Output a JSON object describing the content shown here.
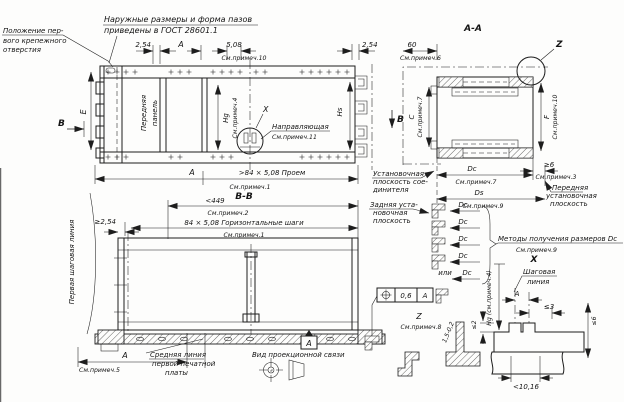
{
  "colors": {
    "ink": "#1d1d1d",
    "paper": "#fdfdfc"
  },
  "icons": {
    "position_tolerance": "circle-crosshair",
    "projection_symbol": "first-angle-truncated-cone"
  },
  "notes": {
    "outer_1": "Наружные размеры и форма пазов",
    "outer_2": "приведены в ГОСТ 28601.1",
    "hole_1": "Положение пер-",
    "hole_2": "вого крепежного",
    "hole_3": "отверстия"
  },
  "top_dims": {
    "left_254": "2,54",
    "a": "А",
    "d508": "5,08",
    "d508_note": "См.примеч.10",
    "right_254": "2,54"
  },
  "front_view": {
    "panel_1": "Передняя",
    "panel_2": "панель",
    "e": "Е",
    "b_left": "В",
    "b_right": "В",
    "hg": "Hg",
    "hg_note": "См.примеч.4",
    "hs": "Hs",
    "x": "Х",
    "guide": "Направляющая",
    "guide_note": "См.примеч.11",
    "opening_a": "А",
    "opening": ">84 × 5,08 Проем",
    "opening_note": "См.примеч.1"
  },
  "view_bb": {
    "title": "В-В",
    "max_width": "<449",
    "max_width_note": "См.примеч.2",
    "steps": "84 × 5,08 Горизонтальные шаги",
    "steps_note": "См.примеч.1",
    "min_254": "≥2,54",
    "first_pitch_line": "Первая шаговая линия",
    "mid_1": "Средняя линия",
    "mid_2": "первой печатной",
    "mid_3": "платы",
    "a_dim": "А",
    "a_note": "См.примеч.5",
    "datum": "А",
    "projection": "Вид проекционной связи"
  },
  "tolerance_frame": {
    "value": "0,6",
    "datum": "А"
  },
  "section_aa": {
    "title": "А-А",
    "d60": "60",
    "d60_note": "См.примеч.6",
    "c": "С",
    "c_note": "См.примеч.7",
    "f": "F",
    "f_note": "См.примеч.10",
    "z": "Z"
  },
  "depth_dims": {
    "dc": "Dc",
    "dc_note": "См.примеч.7",
    "ds": "Ds",
    "ds_note": "См.примеч.9",
    "min6": "≥6",
    "min6_note": "См.примеч.3",
    "conn_1": "Установочная",
    "conn_2": "плоскость сое-",
    "conn_3": "динителя",
    "rear_1": "Задняя уста-",
    "rear_2": "новочная",
    "rear_3": "плоскость",
    "front_1": "Передняя",
    "front_2": "установочная",
    "front_3": "плоскость",
    "dc_row": "Dc",
    "or": "или",
    "methods": "Методы получения размеров Dc",
    "methods_note": "См.примеч.9"
  },
  "detail_z": {
    "z": "Z",
    "note": "См.примеч.8",
    "thickness": "1,5-0,2"
  },
  "detail_x": {
    "title": "Х",
    "pitch_1": "Шаговая",
    "pitch_2": "линия",
    "a": "А",
    "max3": "≤3",
    "max2": "≤2",
    "max6": "≤6",
    "hg_ref": "Hg (см.примеч.4)",
    "slot": "<10,16"
  }
}
